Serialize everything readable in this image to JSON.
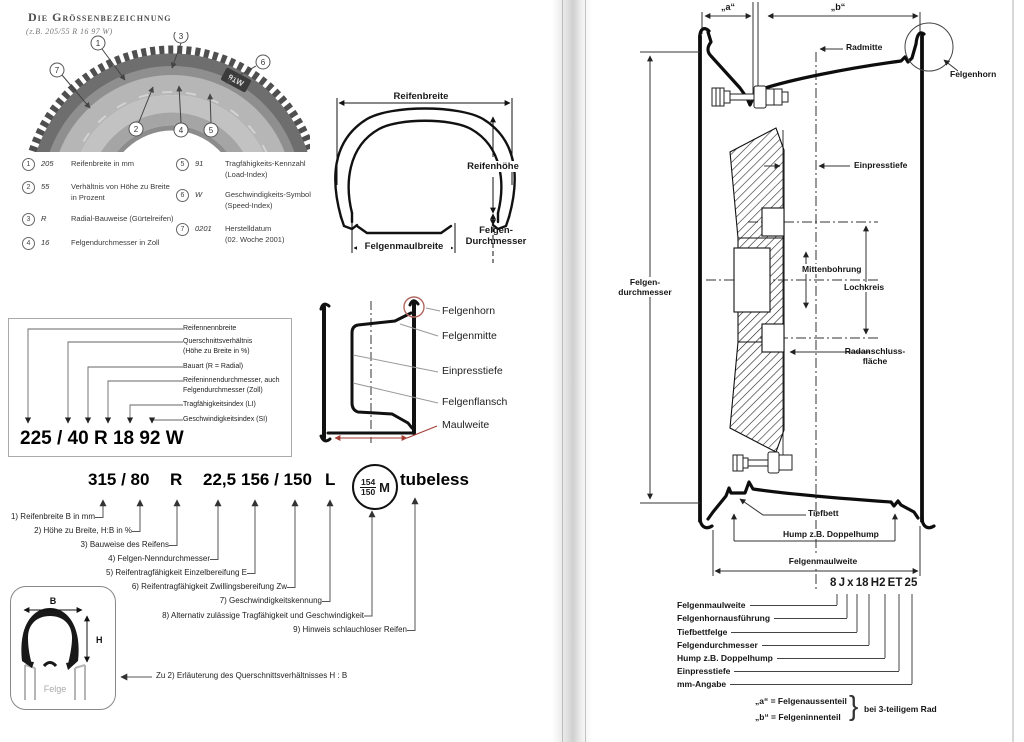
{
  "page_left": {
    "title": "Die Grössenbezeichnung",
    "subtitle": "(z.B. 205/55 R 16 97 W)",
    "tire_photo": {
      "badge": "91W",
      "callouts": [
        "1",
        "2",
        "3",
        "4",
        "5",
        "6",
        "7"
      ]
    },
    "legend": [
      {
        "num": "1",
        "value": "205",
        "desc1": "Reifenbreite in mm",
        "desc2": ""
      },
      {
        "num": "2",
        "value": "55",
        "desc1": "Verhältnis von Höhe zu Breite",
        "desc2": "in Prozent"
      },
      {
        "num": "3",
        "value": "R",
        "desc1": "Radial-Bauweise (Gürtelreifen)",
        "desc2": ""
      },
      {
        "num": "4",
        "value": "16",
        "desc1": "Felgendurchmesser in Zoll",
        "desc2": ""
      },
      {
        "num": "5",
        "value": "91",
        "desc1": "Tragfähigkeits-Kennzahl",
        "desc2": "(Load-Index)"
      },
      {
        "num": "6",
        "value": "W",
        "desc1": "Geschwindigkeits-Symbol",
        "desc2": "(Speed-Index)"
      },
      {
        "num": "7",
        "value": "0201",
        "desc1": "Herstelldatum",
        "desc2": "(02. Woche 2001)"
      }
    ],
    "tire_section": {
      "reifenbreite": "Reifenbreite",
      "reifenhoehe": "Reifenhöhe",
      "felgen": "Felgen-",
      "durchmesser": "Durchmesser",
      "felgenmaulbreite": "Felgenmaulbreite"
    },
    "designation": {
      "code": "225 / 40 R 18 92 W",
      "l1": "Reifennennbreite",
      "l2a": "Querschnittsverhältnis",
      "l2b": "(Höhe zu Breite in %)",
      "l3": "Bauart (R = Radial)",
      "l4a": "Reifeninnendurchmesser, auch",
      "l4b": "Felgendurchmesser (Zoll)",
      "l5": "Tragfähigkeitsindex (LI)",
      "l6": "Geschwindigkeitsindex (SI)"
    },
    "rim_section": {
      "accent_red": "#b4665e",
      "felgenhorn": "Felgenhorn",
      "felgenmitte": "Felgenmitte",
      "einpresstiefe": "Einpresstiefe",
      "felgenflansch": "Felgenflansch",
      "maulweite": "Maulweite"
    },
    "truck": {
      "p1": "315 / 80",
      "p2": "R",
      "p3": "22,5",
      "p4": "156 / 150",
      "p5": "L",
      "frac_top": "154",
      "frac_bottom": "150",
      "m": "M",
      "p7": "tubeless",
      "notes": [
        "1) Reifenbreite B in mm",
        "2) Höhe zu Breite, H:B in %",
        "3) Bauweise des Reifens",
        "4) Felgen-Nenndurchmesser",
        "5) Reifentragfähigkeit Einzelbereifung E",
        "6) Reifentragfähigkeit Zwillingsbereifung Zw",
        "7) Geschwindigkeitskennung",
        "8) Alternativ zulässige Tragfähigkeit und Geschwindigkeit",
        "9) Hinweis schlauchloser Reifen"
      ],
      "zu2": "Zu 2) Erläuterung des Querschnittsverhältnisses H : B"
    },
    "small_diagram": {
      "b": "B",
      "h": "H",
      "felge": "Felge"
    }
  },
  "page_right": {
    "dim_a": "„a“",
    "dim_b": "„b“",
    "radmitte": "Radmitte",
    "felgenhorn": "Felgenhorn",
    "einpresstiefe": "Einpresstiefe",
    "felgendurchmesser1": "Felgen-",
    "felgendurchmesser2": "durchmesser",
    "mittenbohrung": "Mittenbohrung",
    "lochkreis": "Lochkreis",
    "radanschluss1": "Radanschluss-",
    "radanschluss2": "fläche",
    "tiefbett": "Tiefbett",
    "hump": "Hump z.B. Doppelhump",
    "felgenmaulweite": "Felgenmaulweite",
    "code": "8 J x 18 H2 ET 25",
    "code_labels": [
      "Felgenmaulweite",
      "Felgenhornausführung",
      "Tiefbettfelge",
      "Felgendurchmesser",
      "Hump z.B. Doppelhump",
      "Einpresstiefe",
      "mm-Angabe"
    ],
    "note_a": "„a“ = Felgenaussenteil",
    "note_b": "„b“ = Felgeninnenteil",
    "note_brace": "}",
    "note_right": "bei 3-teiligem Rad"
  }
}
